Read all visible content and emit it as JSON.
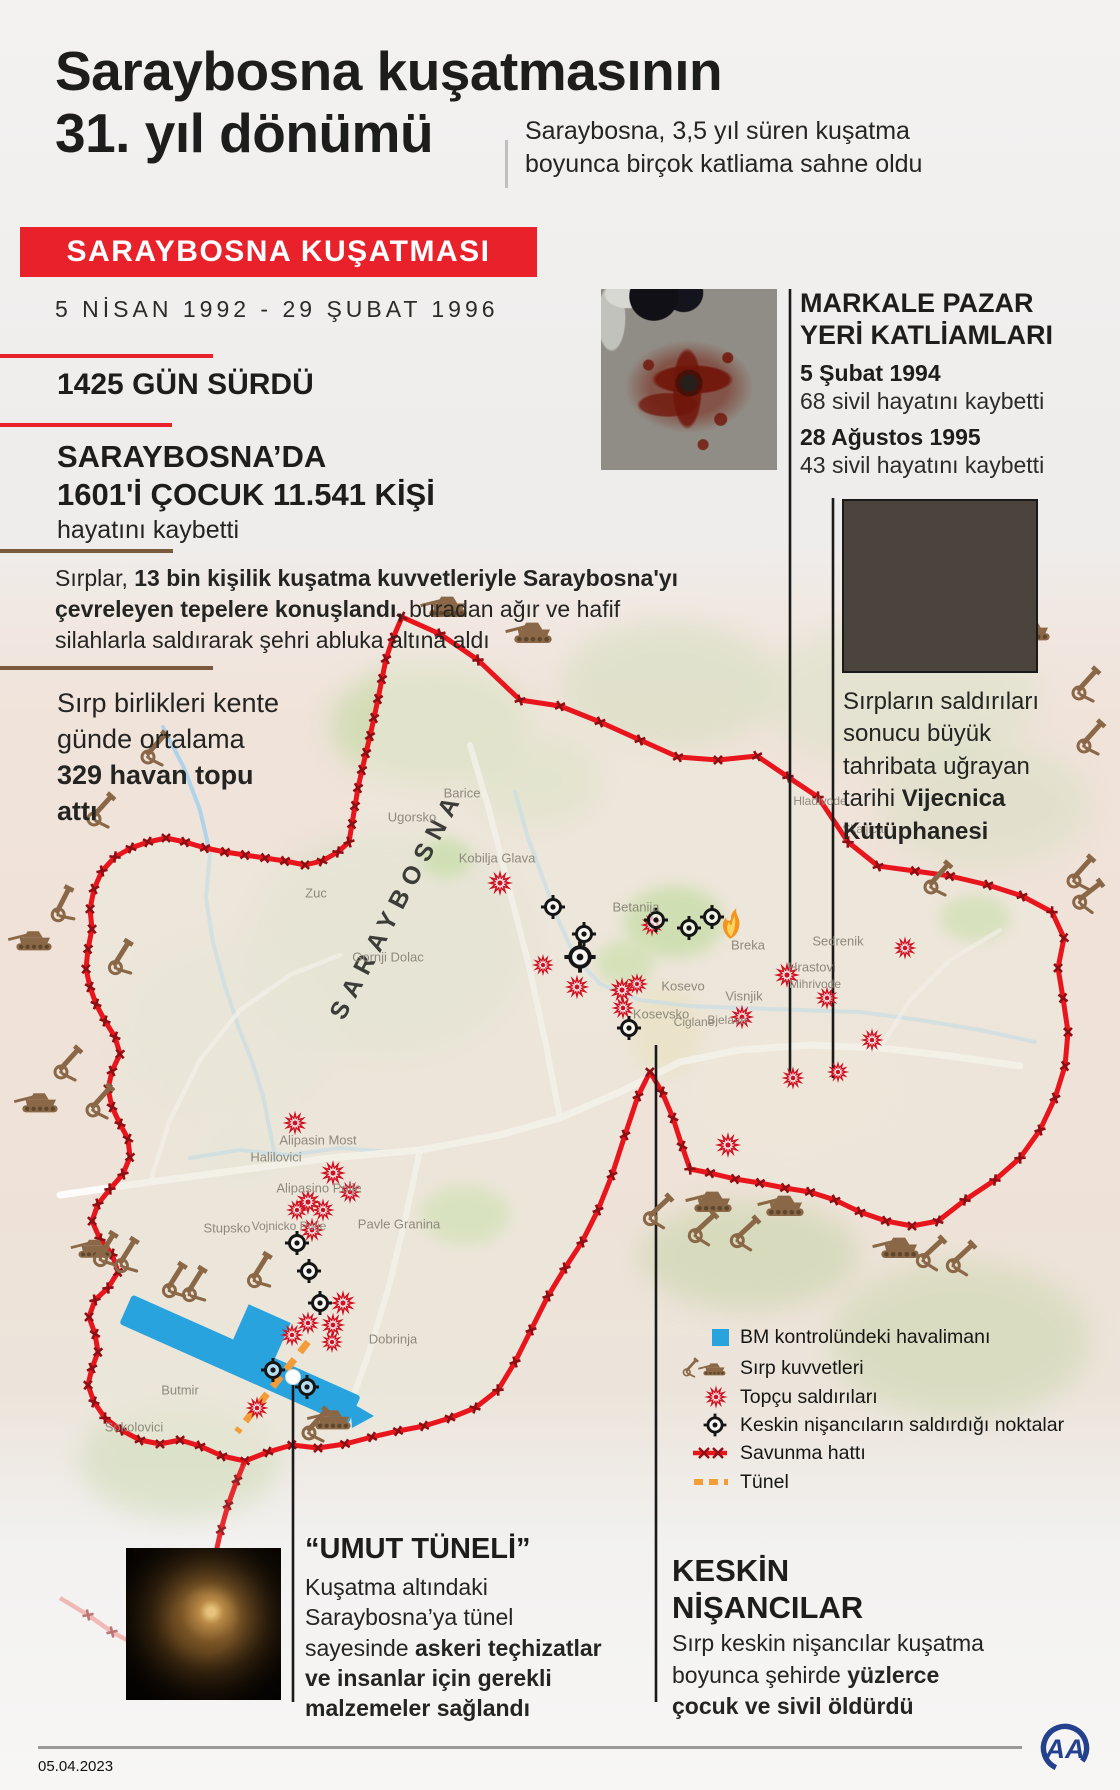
{
  "header": {
    "title_line1": "Saraybosna kuşatmasının",
    "title_line2": "31. yıl dönümü",
    "subtitle": "Saraybosna, 3,5 yıl süren kuşatma boyunca birçok katliama sahne oldu"
  },
  "banner": {
    "label": "SARAYBOSNA KUŞATMASI",
    "date_range": "5 NİSAN 1992 - 29 ŞUBAT 1996"
  },
  "stats": {
    "duration": "1425 GÜN SÜRDÜ",
    "casualties_line1": "SARAYBOSNA’DA",
    "casualties_line2": "1601'İ ÇOCUK 11.541 KİŞİ",
    "casualties_suffix": "hayatını kaybetti",
    "daily_pre": "Sırp birlikleri kente günde ortalama ",
    "daily_bold": "329 havan topu attı"
  },
  "paragraph": {
    "pre": "Sırplar, ",
    "bold": "13 bin kişilik kuşatma kuvvetleriyle Saraybosna'yı çevreleyen tepelere konuşlandı,",
    "post": " buradan ağır ve hafif silahlarla saldırarak şehri abluka altına aldı"
  },
  "markale": {
    "title_line1": "MARKALE PAZAR",
    "title_line2": "YERİ KATLİAMLARI",
    "events": [
      {
        "date": "5 Şubat 1994",
        "toll": "68 sivil hayatını kaybetti"
      },
      {
        "date": "28 Ağustos 1995",
        "toll": "43 sivil hayatını kaybetti"
      }
    ]
  },
  "vijecnica": {
    "caption_pre": "Sırpların saldırıları sonucu büyük tahribata uğrayan tarihi ",
    "caption_bold": "Vijecnica Kütüphanesi"
  },
  "map": {
    "city_label": "SARAYBOSNA",
    "places": [
      {
        "label": "Barice"
      },
      {
        "label": "Ugorsko"
      },
      {
        "label": "Kobilja Glava"
      },
      {
        "label": "Zuc"
      },
      {
        "label": "Gornji Dolac"
      },
      {
        "label": "Betanija"
      },
      {
        "label": "Breka"
      },
      {
        "label": "Kosevo"
      },
      {
        "label": "Visnjik"
      },
      {
        "label": "Kosevsko"
      },
      {
        "label": "Ciglane"
      },
      {
        "label": "Bjelave"
      },
      {
        "label": "Hrastovi"
      },
      {
        "label": "Mihrivode"
      },
      {
        "label": "Sedrenik"
      },
      {
        "label": "Hladivode"
      },
      {
        "label": "Skaljica"
      },
      {
        "label": "Alipasin Most"
      },
      {
        "label": "Halilovici"
      },
      {
        "label": "Alipasino Polje"
      },
      {
        "label": "Stupsko"
      },
      {
        "label": "Vojnicko Polje"
      },
      {
        "label": "Pavle Granina"
      },
      {
        "label": "Dobrinja"
      },
      {
        "label": "Butmir"
      },
      {
        "label": "Sokolovici"
      }
    ],
    "colors": {
      "accent_red": "#e8212b",
      "defense_red": "#e8151d",
      "military_brown": "#8a6847",
      "attack_red": "#cf1222",
      "airport_blue": "#29a3dd",
      "tunnel_orange": "#f29d3a"
    }
  },
  "legend": {
    "items": [
      {
        "icon": "airport-square-icon",
        "label": "BM kontrolündeki havalimanı"
      },
      {
        "icon": "tank-cannon-icon",
        "label": "Sırp kuvvetleri"
      },
      {
        "icon": "artillery-burst-icon",
        "label": "Topçu saldırıları"
      },
      {
        "icon": "sniper-crosshair-icon",
        "label": "Keskin nişancıların saldırdığı noktalar"
      },
      {
        "icon": "defense-line-icon",
        "label": "Savunma hattı"
      },
      {
        "icon": "tunnel-dash-icon",
        "label": "Tünel"
      }
    ]
  },
  "tunnel_section": {
    "title": "“UMUT TÜNELİ”",
    "body_pre": "Kuşatma altındaki Saraybosna’ya tünel sayesinde ",
    "body_bold": "askeri teçhizatlar ve insanlar için gerekli malzemeler sağlandı"
  },
  "sniper_section": {
    "title_line1": "KESKİN",
    "title_line2": "NİŞANCILAR",
    "body_pre": "Sırp keskin nişancılar kuşatma boyunca şehirde ",
    "body_bold": "yüzlerce çocuk ve sivil öldürdü"
  },
  "footer": {
    "date": "05.04.2023",
    "logo_text": "AA"
  }
}
